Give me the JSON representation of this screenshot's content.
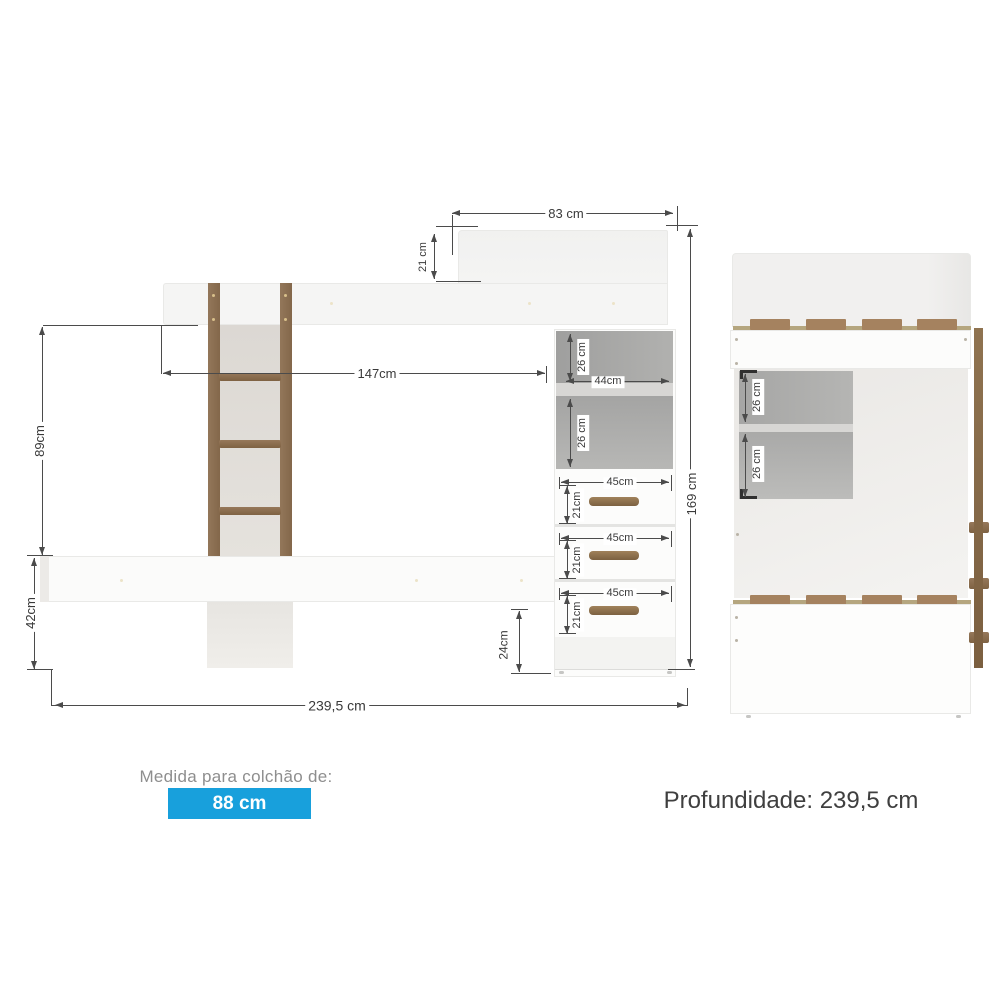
{
  "front_view": {
    "dim_top_width": "83 cm",
    "dim_headboard_height": "21 cm",
    "dim_bed_length": "147cm",
    "dim_upper_section_height": "89cm",
    "dim_lower_section_height": "42cm",
    "dim_total_height": "169 cm",
    "dim_total_width": "239,5 cm",
    "dim_shelf_upper_height": "26 cm",
    "dim_shelf_lower_height": "26 cm",
    "dim_shelf_width": "44cm",
    "dim_base_height": "24cm",
    "drawers": [
      {
        "width": "45cm",
        "height": "21cm"
      },
      {
        "width": "45cm",
        "height": "21cm"
      },
      {
        "width": "45cm",
        "height": "21cm"
      }
    ]
  },
  "side_view": {
    "dim_shelf_upper_height": "26 cm",
    "dim_shelf_lower_height": "26 cm"
  },
  "footer": {
    "mattress_label": "Medida para colchão de:",
    "mattress_size": "88 cm",
    "depth_label": "Profundidade: 239,5 cm"
  },
  "colors": {
    "badge_blue": "#18a0dc",
    "wood_brown": "#8d7254",
    "slat_brown": "#a5825f",
    "opening_gray": "#adadad",
    "dim_line": "#4b4b4b"
  }
}
